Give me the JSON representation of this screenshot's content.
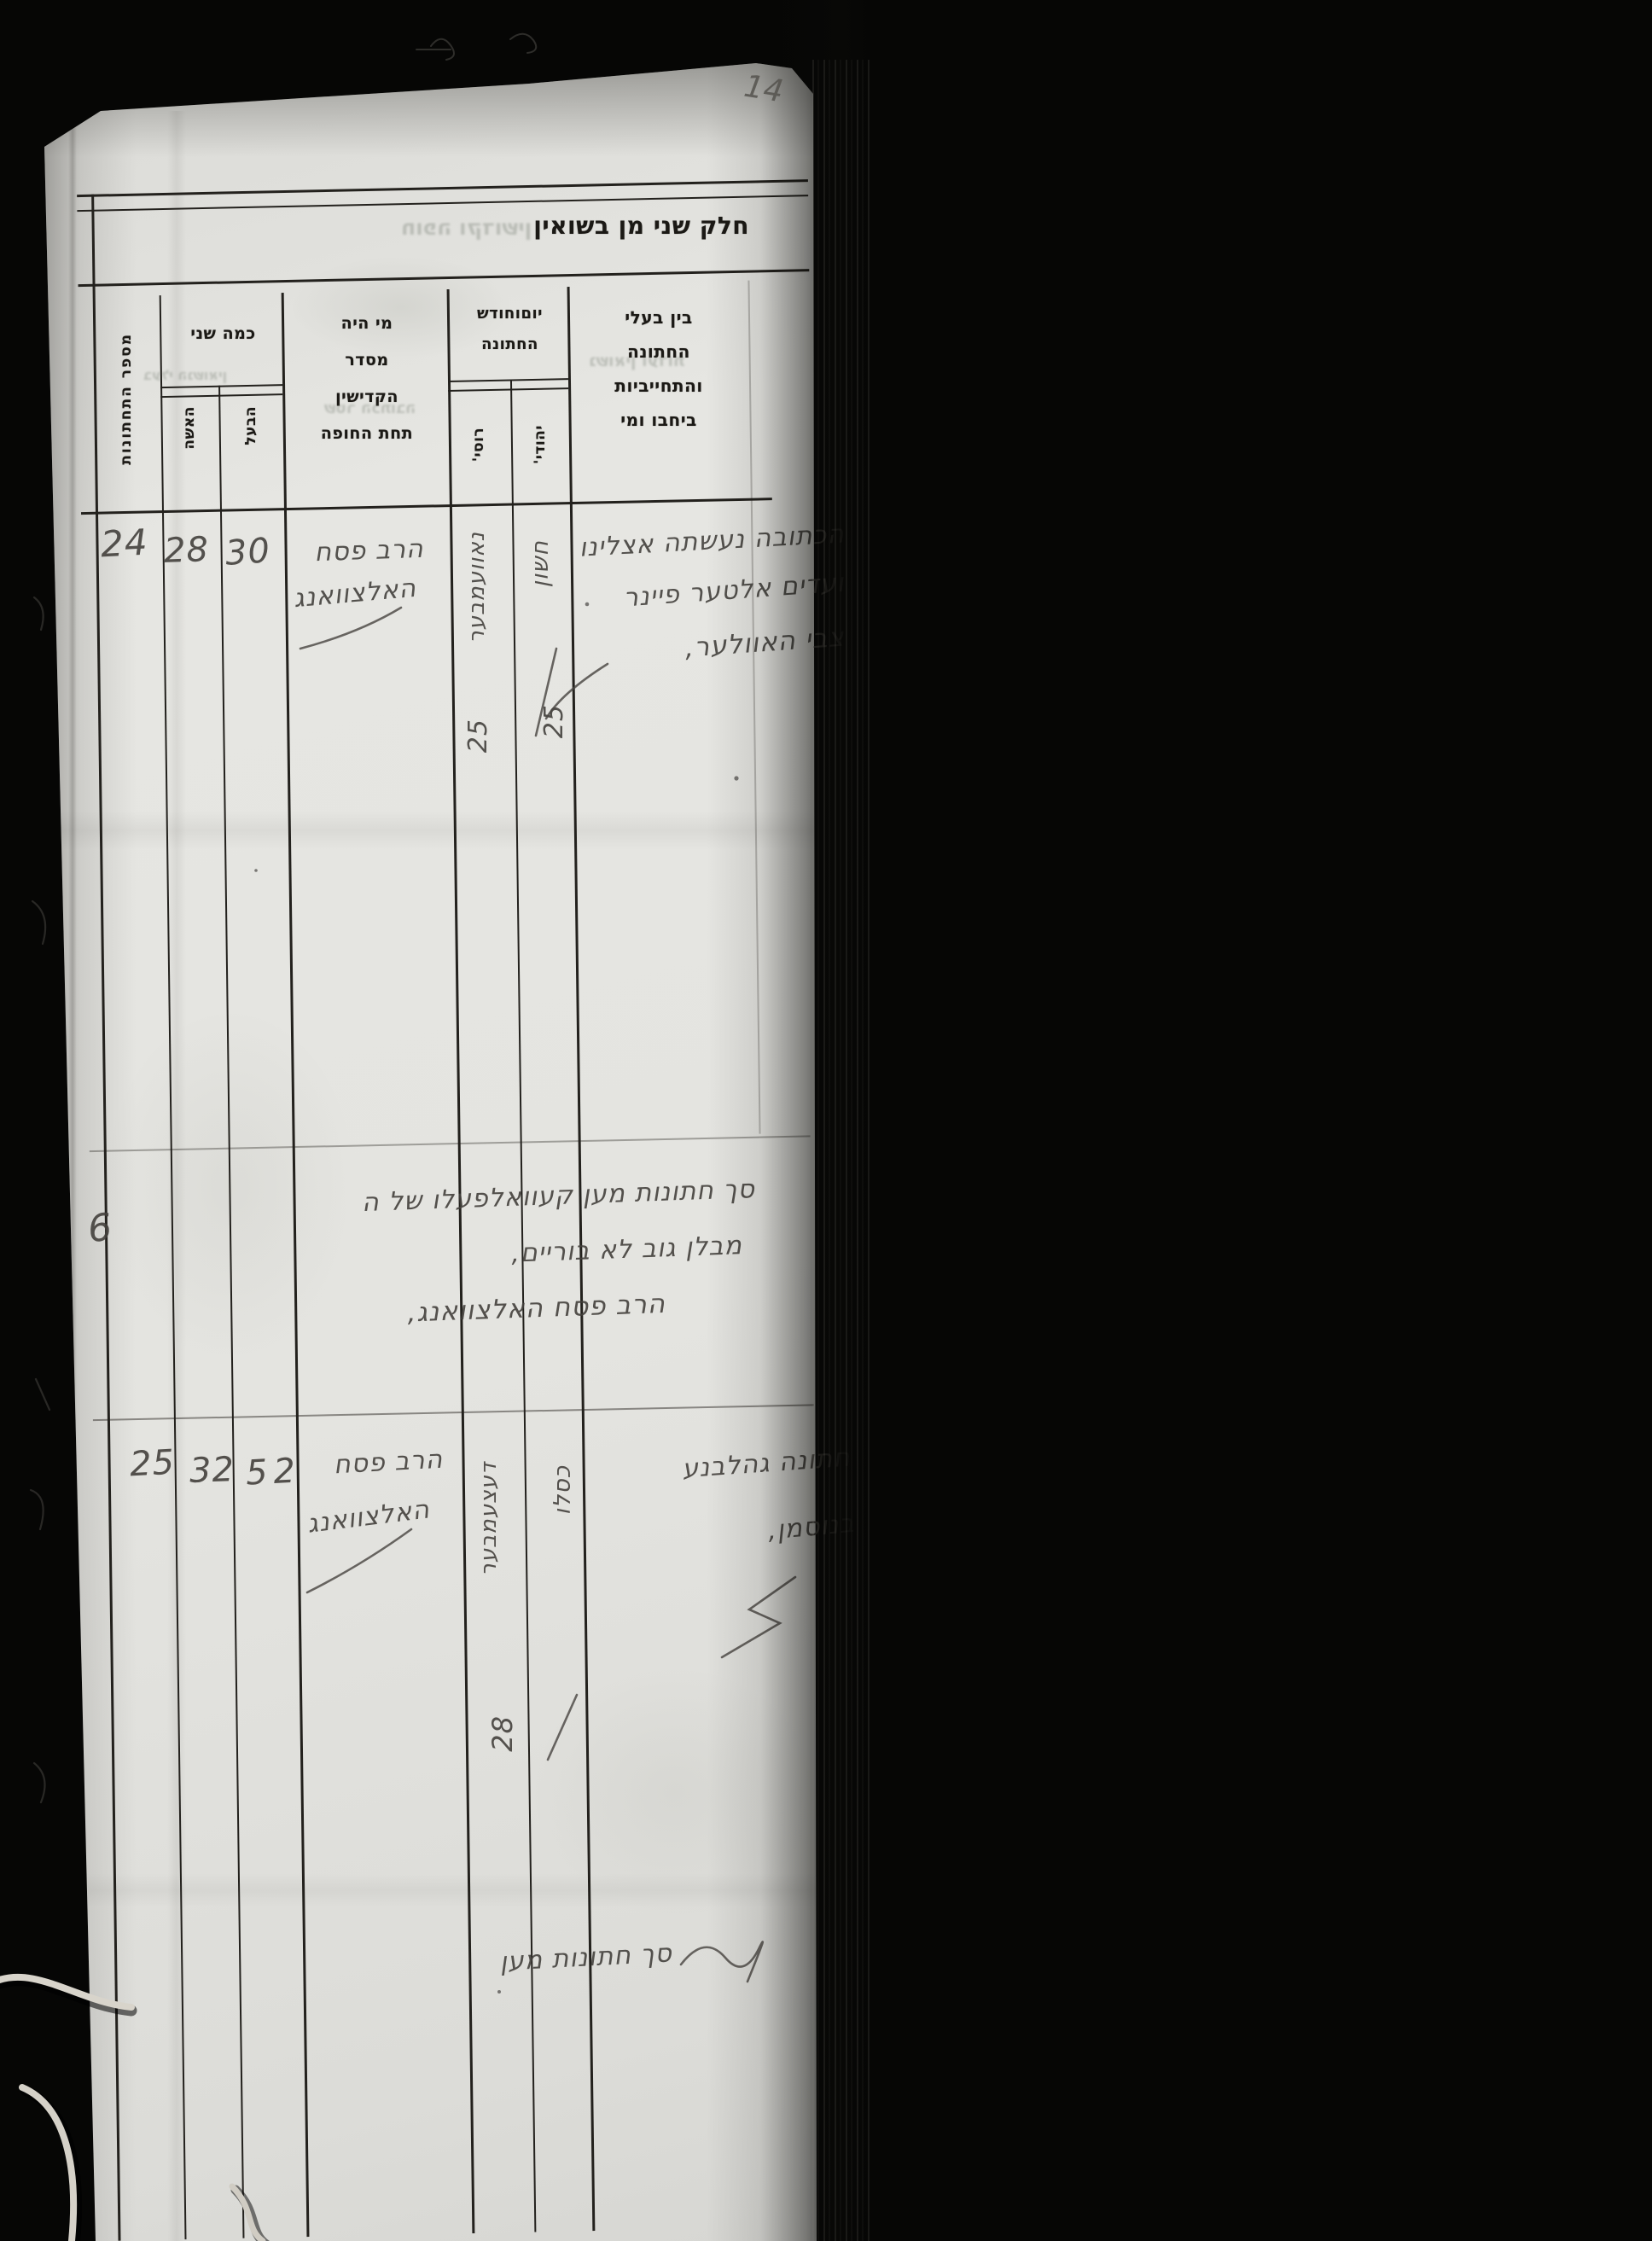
{
  "page": {
    "number": "14",
    "title": "חלק שני מן בשואין"
  },
  "header": {
    "records_label": "מספר התחתונות",
    "ages": {
      "label": "כמה שני",
      "groom": "הבעל",
      "bride": "האשה"
    },
    "officiant_lines": [
      "מי היה",
      "מסדר",
      "הקדישין",
      "תחת החופה"
    ],
    "date": {
      "line1": "יוםוחודש",
      "line2": "החתונה",
      "jewish": "יהודי'",
      "civil": "רוסי'"
    },
    "documents_lines": [
      "בין בעלי",
      "החתונה",
      "והתחייביות",
      "ביחבו ומי"
    ]
  },
  "rows": [
    {
      "number": "24",
      "bride_age": "28",
      "groom_age": "30",
      "officiant_line1": "הרב פסח",
      "officiant_line2": "האלצוואנג",
      "civil_month": "נאוועמבער",
      "civil_day": "25",
      "jewish_month": "חשון",
      "jewish_day": "25",
      "entry_line1": "הכתובה נעשתה אצלינו",
      "entry_line2": "ועדים אלטער פיינר",
      "entry_line3": "צבי האוולער,"
    },
    {
      "number": "25",
      "bride_age": "32",
      "groom_age": "52",
      "officiant_line1": "הרב פסח",
      "officiant_line2": "האלצוואנג",
      "civil_month": "דעצעמבער",
      "civil_day": "28",
      "jewish_month": "כסלו",
      "jewish_day": "",
      "entry_line1": "חתונה גהלבנע",
      "entry_line2": "בנוסמן,",
      "entry_line3": ""
    }
  ],
  "summary": {
    "count": "6",
    "line1": "סך חתונות מען קעוואלפעלו של ה",
    "line2": "מבלן גוב לא בוריים,",
    "line3": "הרב פסח האלצוואנג,"
  },
  "footer": {
    "line": "סך חתונות מען"
  },
  "bleed": [
    "נשואין ועדות",
    "שטר הכתובה",
    "חופה וקדושין",
    "בעלי הנשואין"
  ],
  "colors": {
    "paper": "#e4e4e0",
    "ink": "#44413d",
    "printed": "#1b1915",
    "line": "#23211d"
  }
}
